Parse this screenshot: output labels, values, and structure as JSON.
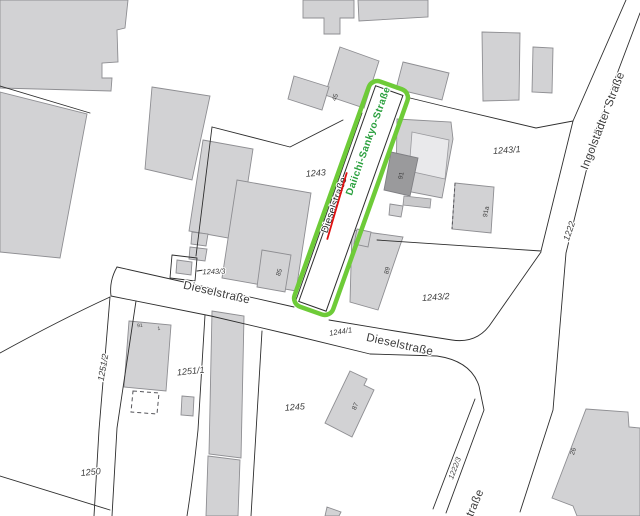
{
  "map_labels": {
    "street_diesel_w": "Dieselstraße",
    "street_diesel_e": "Dieselstraße",
    "street_ingolstaedter": "Ingolstädter Straße",
    "street_partial_south": "straße",
    "renaming_old": "Dieselstraße",
    "renaming_new": "Daiichi-Sankyo-Straße"
  },
  "parcel_labels": {
    "p1243": "1243",
    "p1243_1": "1243/1",
    "p1243_2": "1243/2",
    "p1243_3": "1243/3",
    "p1244_1": "1244/1",
    "p1245": "1245",
    "p1250": "1250",
    "p1251_1": "1251/1",
    "p1251_2": "1251/2",
    "p1222": "1222",
    "p1222_3": "1222/3"
  },
  "building_numbers": {
    "b45": "45",
    "b85": "85",
    "b89": "89",
    "b87": "87",
    "b91": "91",
    "b91a": "91a",
    "b26": "26",
    "bh1": "91",
    "bh2": "1"
  },
  "colors": {
    "highlight_outline": "#6ecb38",
    "new_name_green": "#2aa03e",
    "strike_red": "#e01010",
    "building_fill": "#d2d2d4",
    "building_dark": "#9a9a9c",
    "parcel_line": "#2e2e2e",
    "background": "#ffffff"
  }
}
